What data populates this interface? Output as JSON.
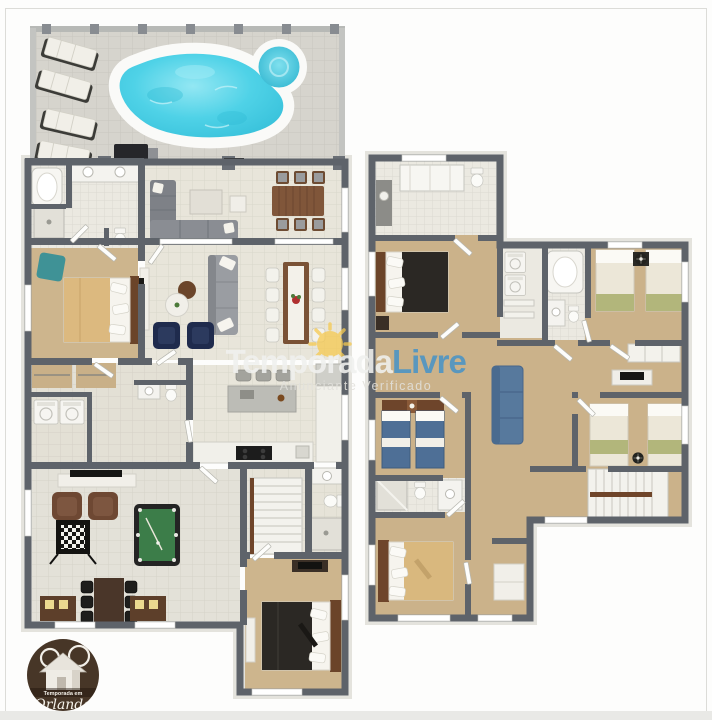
{
  "watermark": {
    "brand_first": "Temporada",
    "brand_second": "Livre",
    "subtitle": "Anunciante Verificado",
    "brand_first_color": "#f0f1ef",
    "brand_second_color": "#4a94c6",
    "sun_color": "#f6c94f"
  },
  "badge_logo": {
    "line_small": "Temporada em",
    "line_script": "Orlando",
    "bg_color": "#473627"
  },
  "palette": {
    "wall_gray": "#5e636a",
    "pool_water": "#4ad0e6",
    "deck_tile": "#d6d4cd",
    "interior_tile": "#e8e5da",
    "carpet_tan": "#cdb58d",
    "pool_table_felt": "#3c7d49",
    "navy_chair": "#1f2b4d",
    "teal_chair": "#3f9296",
    "loft_sofa": "#57799d",
    "olive_bedding": "#b2b67b",
    "denim_bedding": "#4e6f96",
    "tan_bedding": "#dcb97f",
    "dark_bedding": "#2b2824",
    "wood": "#7d5233"
  }
}
